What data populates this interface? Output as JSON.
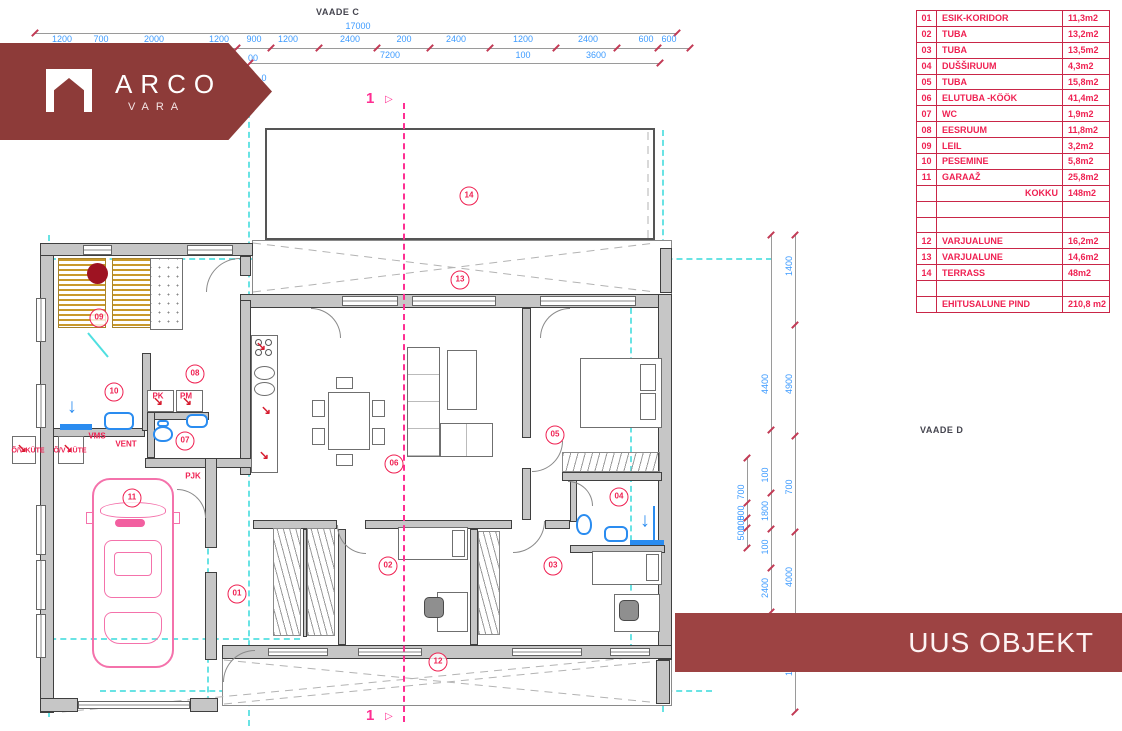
{
  "colors": {
    "logo_maroon": "#8d3b39",
    "banner_maroon": "#9d4343",
    "table_red": "#ef2152",
    "dim_blue": "#3d9bff",
    "grid_cyan": "#4fdfe0",
    "section_pink": "#ff2e92",
    "sauna_wood": "#c9992b",
    "heater_red": "#9e1322",
    "car_pink": "#f472ab",
    "fixture_blue": "#2a8cf0"
  },
  "view_labels": {
    "top": "VAADE C",
    "right": "VAADE D"
  },
  "logo": {
    "title": "ARCO",
    "subtitle": "VARA"
  },
  "object_banner": {
    "label": "UUS OBJEKT"
  },
  "section": {
    "number": "1"
  },
  "icons": {
    "section_flag": "▷",
    "red_arrow": "↘",
    "blue_arrow": "↓"
  },
  "dims": {
    "total": "17000",
    "top_row1": [
      {
        "t": "1200",
        "x": 62
      },
      {
        "t": "700",
        "x": 101
      },
      {
        "t": "2000",
        "x": 154
      },
      {
        "t": "1200",
        "x": 219
      },
      {
        "t": "900",
        "x": 254
      },
      {
        "t": "1200",
        "x": 288
      },
      {
        "t": "2400",
        "x": 350
      },
      {
        "t": "200",
        "x": 404
      },
      {
        "t": "2400",
        "x": 456
      },
      {
        "t": "1200",
        "x": 523
      },
      {
        "t": "2400",
        "x": 588
      },
      {
        "t": "600",
        "x": 646
      },
      {
        "t": "600",
        "x": 669
      }
    ],
    "top_row2": [
      {
        "t": "00",
        "x": 253,
        "y": 63
      },
      {
        "t": "7200",
        "x": 390,
        "y": 60
      },
      {
        "t": "100",
        "x": 523,
        "y": 60
      },
      {
        "t": "3600",
        "x": 596,
        "y": 60
      },
      {
        "t": "0",
        "x": 264,
        "y": 83
      }
    ],
    "right_col1": [
      {
        "t": "1400",
        "y": 266
      },
      {
        "t": "4900",
        "y": 384
      },
      {
        "t": "700",
        "y": 487
      },
      {
        "t": "4000",
        "y": 577
      },
      {
        "t": "1400",
        "y": 666
      }
    ],
    "right_col2": [
      {
        "t": "4400",
        "y": 384
      },
      {
        "t": "100",
        "y": 475
      },
      {
        "t": "1800",
        "y": 511
      },
      {
        "t": "100",
        "y": 547
      },
      {
        "t": "2400",
        "y": 588
      }
    ],
    "right_col3": [
      {
        "t": "700",
        "y": 492
      },
      {
        "t": "500",
        "y": 513
      },
      {
        "t": "100",
        "y": 523
      },
      {
        "t": "500",
        "y": 533
      }
    ]
  },
  "rooms": [
    {
      "n": "01",
      "x": 237,
      "y": 594
    },
    {
      "n": "02",
      "x": 388,
      "y": 566
    },
    {
      "n": "03",
      "x": 553,
      "y": 566
    },
    {
      "n": "04",
      "x": 619,
      "y": 497
    },
    {
      "n": "05",
      "x": 555,
      "y": 435
    },
    {
      "n": "06",
      "x": 394,
      "y": 464
    },
    {
      "n": "07",
      "x": 185,
      "y": 441
    },
    {
      "n": "08",
      "x": 195,
      "y": 374
    },
    {
      "n": "09",
      "x": 99,
      "y": 318
    },
    {
      "n": "10",
      "x": 114,
      "y": 392
    },
    {
      "n": "11",
      "x": 132,
      "y": 498
    },
    {
      "n": "12",
      "x": 438,
      "y": 662
    },
    {
      "n": "13",
      "x": 460,
      "y": 280
    },
    {
      "n": "14",
      "x": 469,
      "y": 196
    }
  ],
  "plan_labels": [
    {
      "t": "VMS",
      "x": 97,
      "y": 436
    },
    {
      "t": "VENT",
      "x": 126,
      "y": 444
    },
    {
      "t": "PJK",
      "x": 193,
      "y": 476
    },
    {
      "t": "PK",
      "x": 158,
      "y": 396
    },
    {
      "t": "PM",
      "x": 186,
      "y": 396
    },
    {
      "t": "Õ/V KÜTE",
      "x": 28,
      "y": 451
    },
    {
      "t": "Õ/V KÜTE",
      "x": 70,
      "y": 451
    }
  ],
  "room_table": {
    "rows": [
      {
        "no": "01",
        "name": "ESIK-KORIDOR",
        "area": "11,3m2"
      },
      {
        "no": "02",
        "name": "TUBA",
        "area": "13,2m2"
      },
      {
        "no": "03",
        "name": "TUBA",
        "area": "13,5m2"
      },
      {
        "no": "04",
        "name": "DUŠŠIRUUM",
        "area": "4,3m2"
      },
      {
        "no": "05",
        "name": "TUBA",
        "area": "15,8m2"
      },
      {
        "no": "06",
        "name": "ELUTUBA -KÖÖK",
        "area": "41,4m2"
      },
      {
        "no": "07",
        "name": "WC",
        "area": "1,9m2"
      },
      {
        "no": "08",
        "name": "EESRUUM",
        "area": "11,8m2"
      },
      {
        "no": "09",
        "name": "LEIL",
        "area": "3,2m2"
      },
      {
        "no": "10",
        "name": "PESEMINE",
        "area": "5,8m2"
      },
      {
        "no": "11",
        "name": "GARAAŽ",
        "area": "25,8m2"
      },
      {
        "no": "",
        "name": "KOKKU",
        "area": "148m2",
        "name_align": "right"
      },
      {
        "no": "",
        "name": "",
        "area": ""
      },
      {
        "no": "",
        "name": "",
        "area": ""
      },
      {
        "no": "12",
        "name": "VARJUALUNE",
        "area": "16,2m2"
      },
      {
        "no": "13",
        "name": "VARJUALUNE",
        "area": "14,6m2"
      },
      {
        "no": "14",
        "name": "TERRASS",
        "area": "48m2"
      },
      {
        "no": "",
        "name": "",
        "area": ""
      },
      {
        "no": "",
        "name": "EHITUSALUNE PIND",
        "area": "210,8 m2"
      }
    ]
  }
}
